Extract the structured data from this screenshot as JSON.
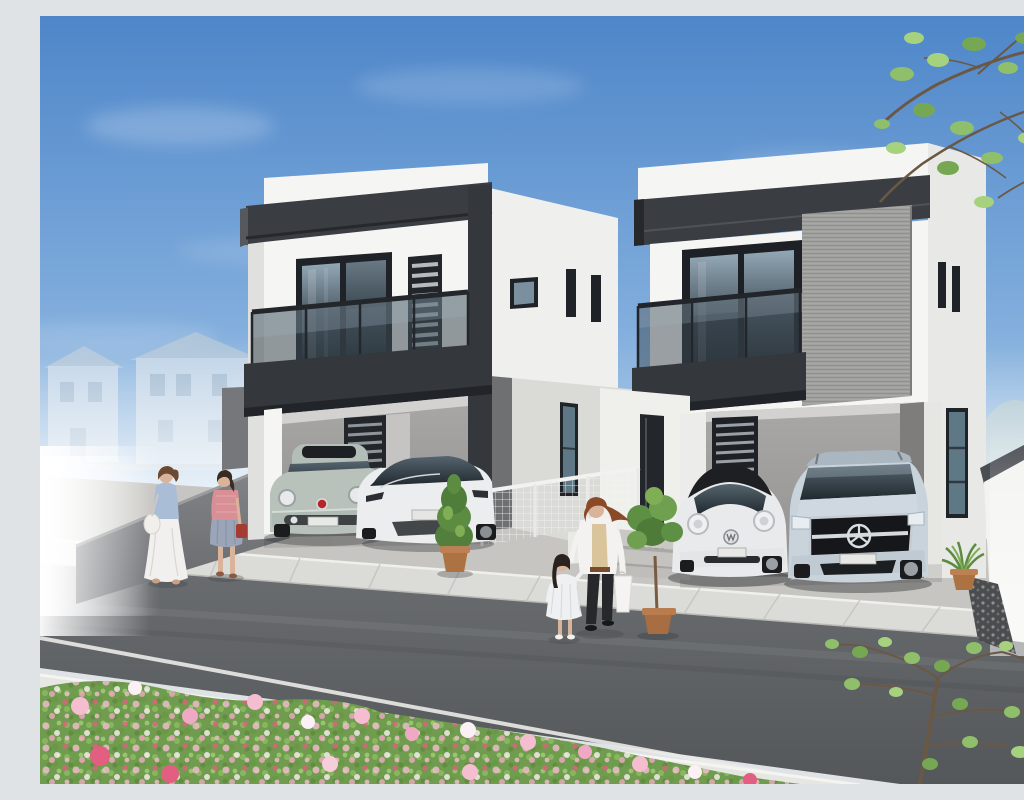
{
  "scene": {
    "title": "Modern duplex houses – exterior architectural rendering",
    "description": "Daytime architectural rendering of two modern white two-story houses with charcoal flat-roof fascias, glass balconies and built-in carports; four parked cars (Fiat 500, Tesla Model 3, VW Beetle, Mercedes EQC), pedestrians on the street, and an azalea hedge in the foreground.",
    "houses": [
      {
        "id": "left-house",
        "walls": "white",
        "fascia": "charcoal",
        "features": [
          "glass balcony",
          "louver window",
          "carport with two cars"
        ]
      },
      {
        "id": "right-house",
        "walls": "white",
        "fascia": "charcoal",
        "features": [
          "glass balcony",
          "gray textured feature panel",
          "carport with two cars",
          "tall entry window"
        ]
      }
    ],
    "vehicles": [
      {
        "id": "fiat-500",
        "body_color": "#b8c2bb"
      },
      {
        "id": "tesla-model-3",
        "body_color": "#ecedee"
      },
      {
        "id": "vw-beetle",
        "body_color": "#e9eaeb",
        "roof_color": "#1d1f22"
      },
      {
        "id": "mercedes-eqc",
        "body_color": "#c9d3db"
      }
    ],
    "people": [
      {
        "id": "woman-blue-top",
        "clothing": [
          "light blue top",
          "long white skirt",
          "white shoulder bag"
        ]
      },
      {
        "id": "woman-pink-top",
        "clothing": [
          "pink top",
          "blue-gray skirt",
          "red handbag"
        ]
      },
      {
        "id": "mother",
        "clothing": [
          "white jacket",
          "beige top",
          "black pants",
          "white shopping bag"
        ]
      },
      {
        "id": "girl",
        "clothing": [
          "white dress",
          "white shoes"
        ]
      }
    ],
    "landscape": [
      "blue sky with thin clouds",
      "faded distant houses and trees",
      "azalea hedge with pink and white flowers",
      "young green trees",
      "asphalt road with white edge line",
      "concrete sidewalks",
      "gray retaining wall with steps",
      "white mesh fence",
      "potted plants"
    ]
  },
  "colors": {
    "sky-top": "#4e86c9",
    "sky-mid": "#82aedd",
    "sky-low": "#b9d3ea",
    "sky-horizon": "#eef3f6",
    "charcoal": "#3a3d42",
    "charcoal-deep": "#26282c",
    "wall-white": "#f5f5f3",
    "wall-shade": "#e7e7e5",
    "wall-dim": "#dadad7",
    "panel-gray": "#a0a09e",
    "carport-light": "#a9a8a6",
    "carport-dark": "#929190",
    "glass-top": "#93a8b6",
    "glass-mid": "#46535d",
    "glass-deep": "#20282e",
    "road-top": "#6a6d70",
    "road-bottom": "#54575a",
    "sidewalk": "#dbdbd7",
    "sidewalk-near": "#e6e6e2",
    "driveway": "#c6c5c1",
    "retaining-wall": "#7b7d80",
    "hedge": "#6f9c4e",
    "leaf": "#8cbb62",
    "flower-pink": "#f4bed0",
    "flower-white": "#fbf0f4",
    "flower-crimson": "#e25f82",
    "fiat": "#b8c2bb",
    "tesla": "#ecedee",
    "beetle": "#e9eaeb",
    "beetle-roof": "#1d1f22",
    "mercedes": "#c9d3db",
    "terracotta": "#ad7242",
    "branch": "#6b5844",
    "skin": "#d9b49a"
  }
}
